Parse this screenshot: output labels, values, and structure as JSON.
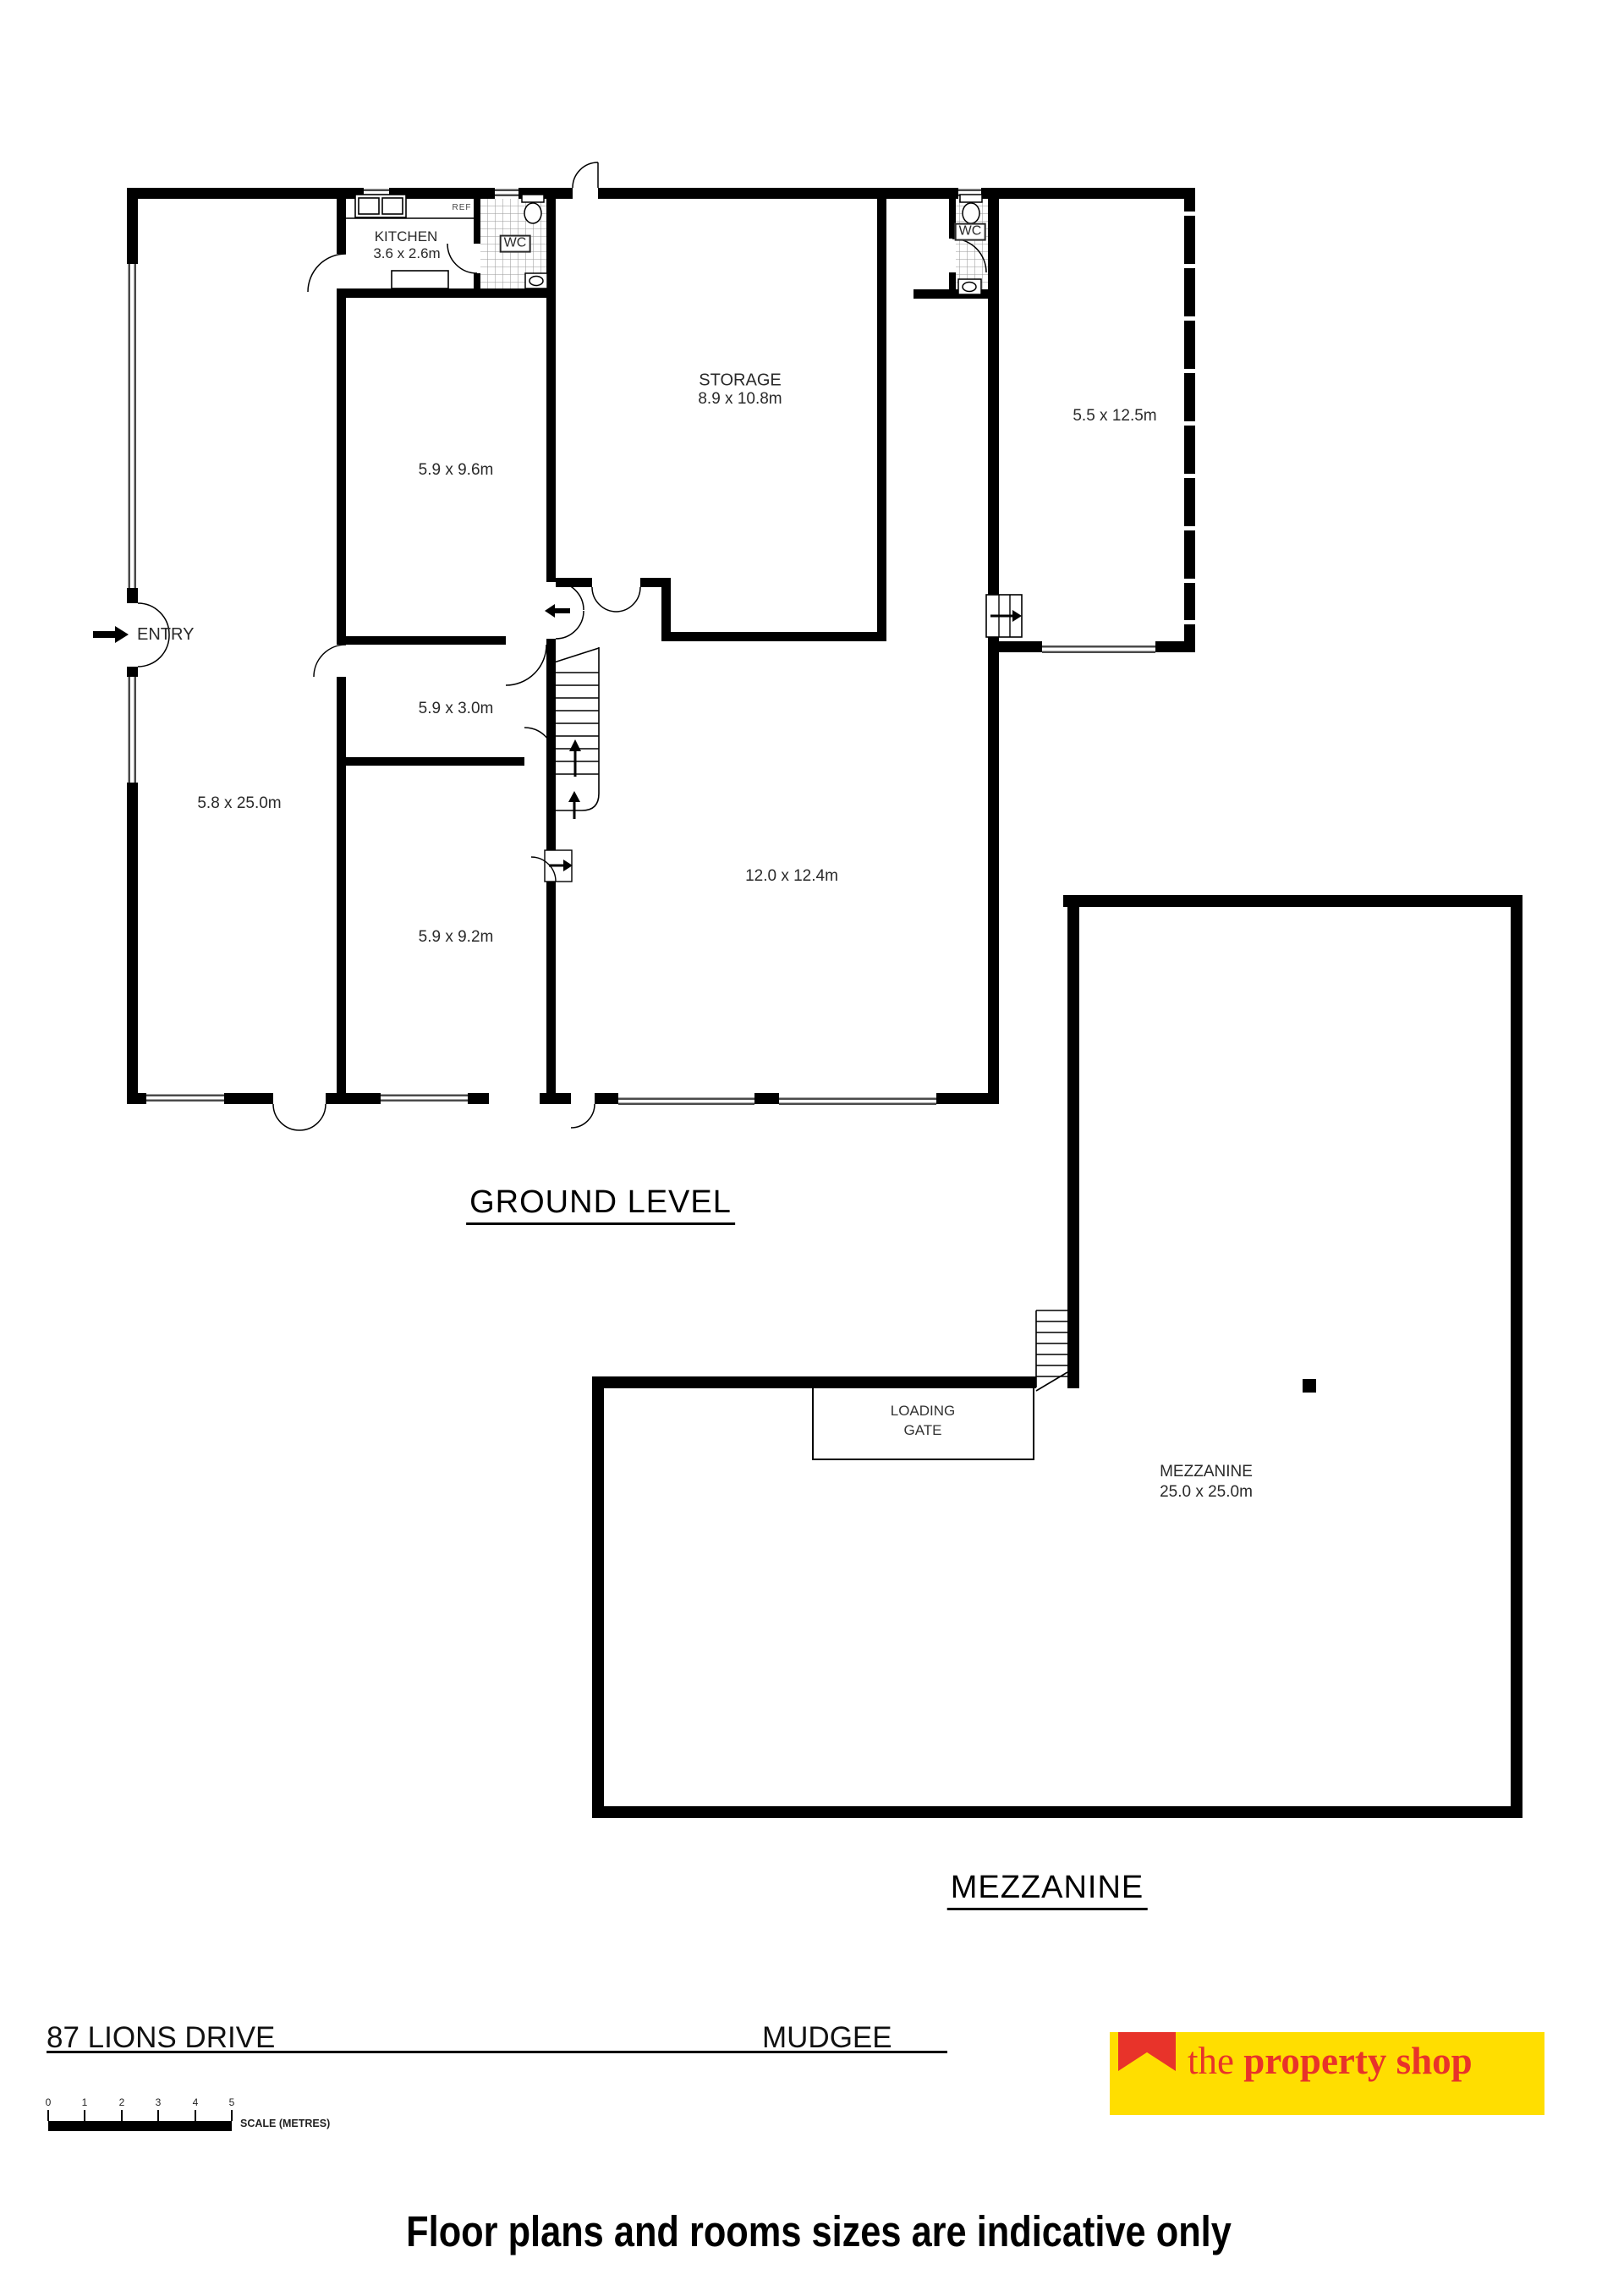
{
  "ground": {
    "title": "GROUND LEVEL",
    "labels": {
      "entry": "ENTRY",
      "kitchen_name": "KITCHEN",
      "kitchen_dims": "3.6 x 2.6m",
      "storage_name": "STORAGE",
      "storage_dims": "8.9 x 10.8m",
      "wc_left": "WC",
      "wc_right": "WC",
      "ref": "REF",
      "room_left": "5.8 x 25.0m",
      "room_top_mid": "5.9 x 9.6m",
      "room_mid": "5.9 x 3.0m",
      "room_lower_mid": "5.9 x 9.2m",
      "hall": "12.0 x 12.4m",
      "room_right": "5.5 x 12.5m"
    }
  },
  "mezzanine": {
    "title": "MEZZANINE",
    "labels": {
      "loading_line1": "LOADING",
      "loading_line2": "GATE",
      "name": "MEZZANINE",
      "dims": "25.0 x 25.0m"
    }
  },
  "footer": {
    "address": "87 LIONS DRIVE",
    "city": "MUDGEE",
    "scale_label": "SCALE (METRES)",
    "scale_numbers": [
      "0",
      "1",
      "2",
      "3",
      "4",
      "5"
    ],
    "logo_the": "the ",
    "logo_rest": "property shop",
    "disclaimer": "Floor plans and rooms sizes are indicative only"
  },
  "colors": {
    "wall": "#000000",
    "logo_bg": "#FFDE00",
    "logo_red": "#E8332A"
  }
}
